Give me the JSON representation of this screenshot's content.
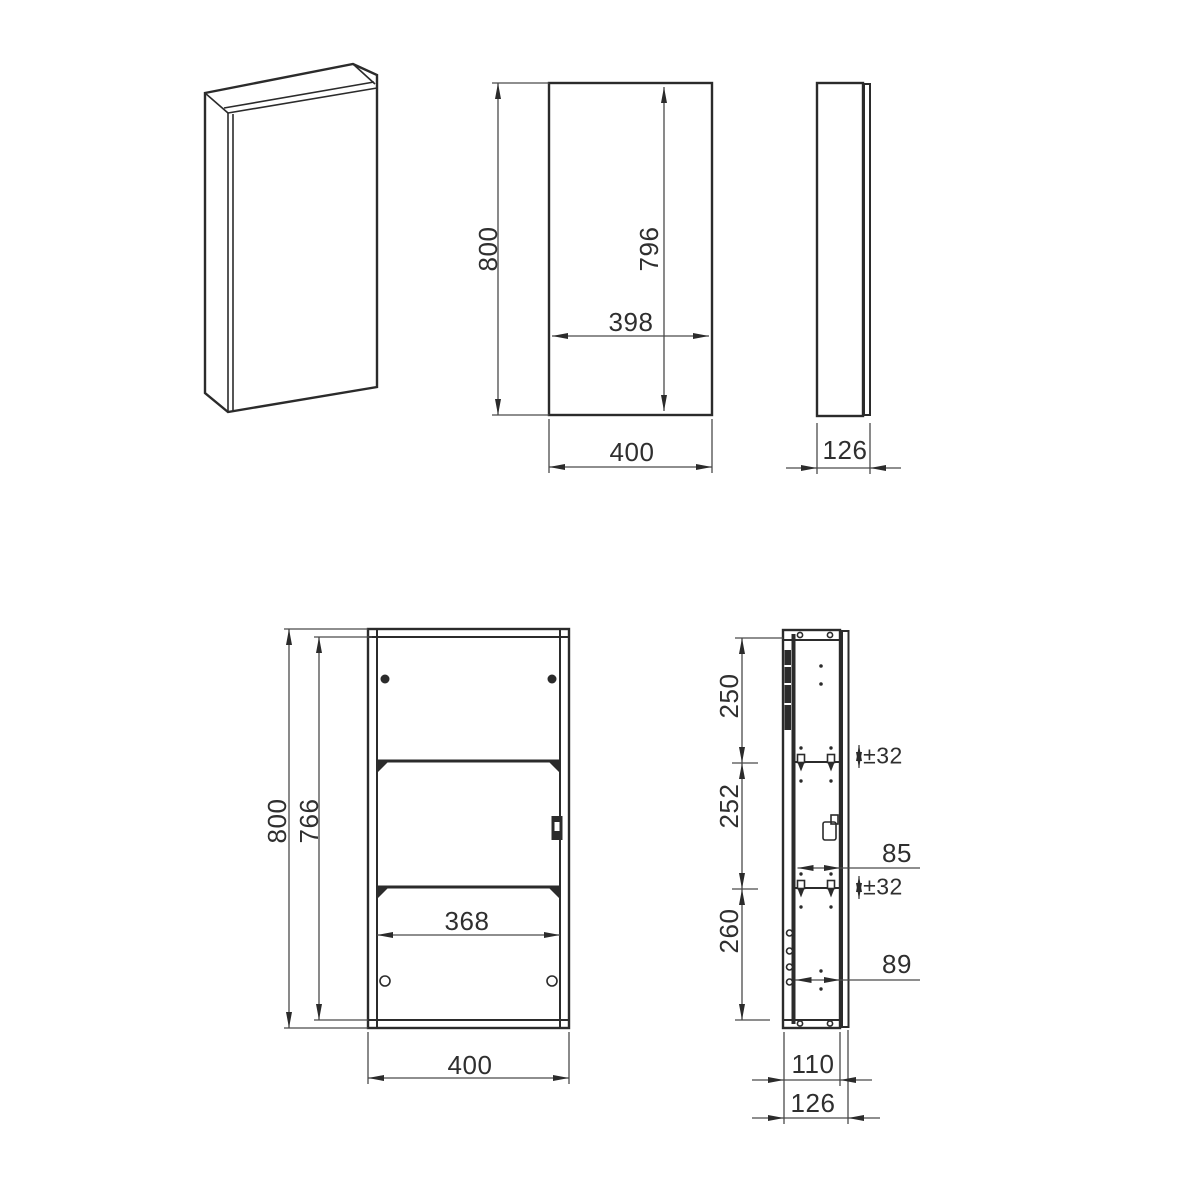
{
  "title": "cabinet-technical-drawing",
  "colors": {
    "line": "#2b2b2b",
    "dim_line": "#4a4a4a",
    "text": "#2f2f2f",
    "background": "#ffffff"
  },
  "views": {
    "front": {
      "height": "800",
      "door_height": "796",
      "door_width": "398",
      "width": "400"
    },
    "side": {
      "depth": "126"
    },
    "internal_front": {
      "height": "800",
      "inner_height": "766",
      "inner_width": "368",
      "width": "400"
    },
    "internal_side": {
      "top_section": "250",
      "middle_section": "252",
      "bottom_section": "260",
      "shelf_adjust_top": "±32",
      "shelf_adjust_bottom": "±32",
      "hinge_plate_offset": "85",
      "bottom_hole_offset": "89",
      "carcass_depth": "110",
      "total_depth": "126"
    }
  }
}
